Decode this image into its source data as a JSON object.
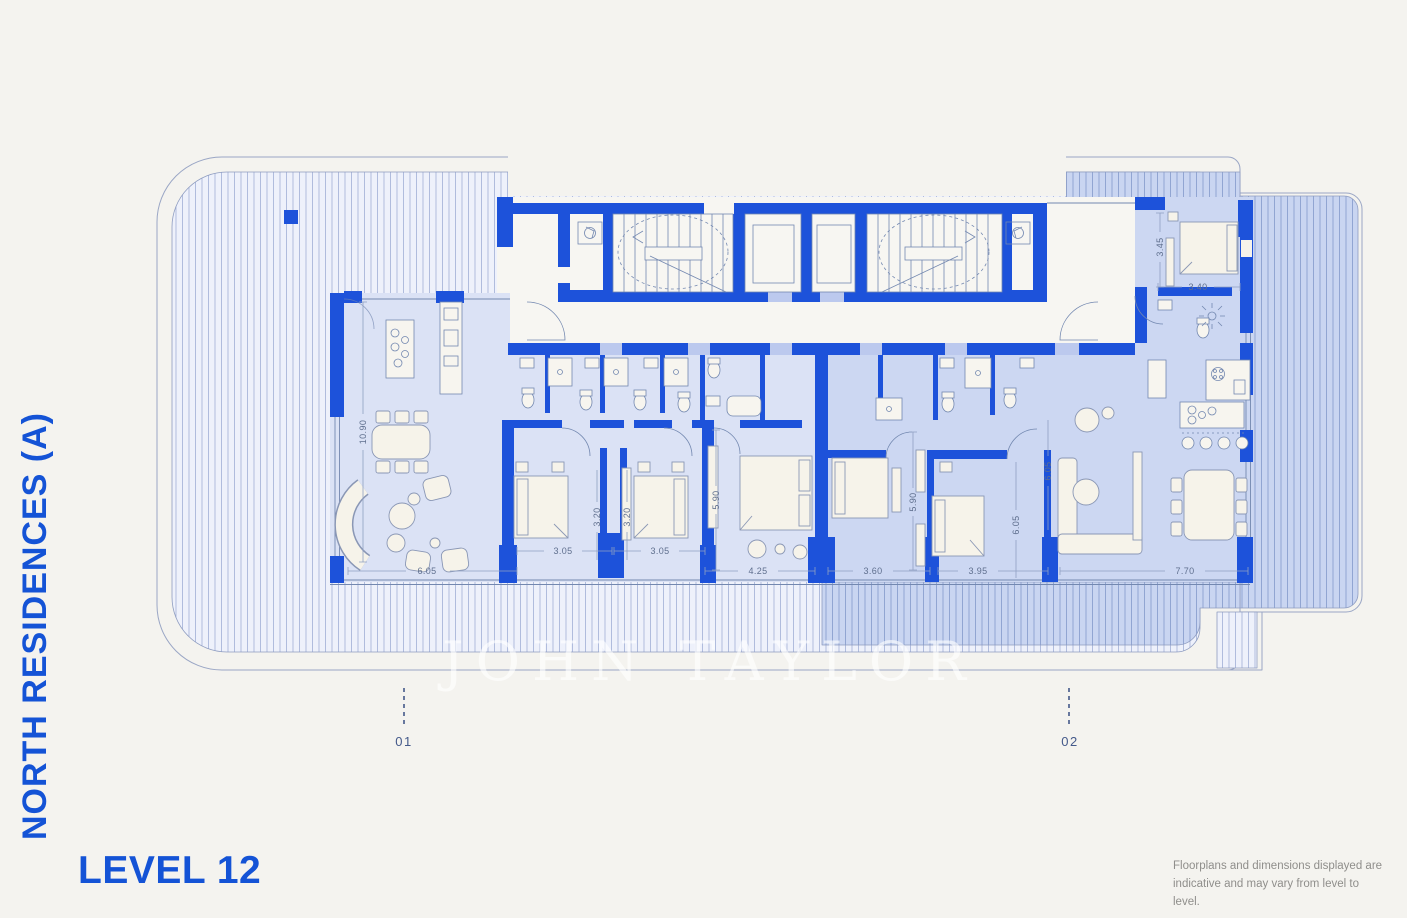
{
  "branding": {
    "project_title": "NORTH RESIDENCES (A)",
    "level_label": "LEVEL 12",
    "watermark": "JOHN TAYLOR"
  },
  "footer": {
    "disclaimer_line1": "Floorplans and dimensions displayed are",
    "disclaimer_line2": "indicative and may vary from level to level."
  },
  "unit_markers": [
    {
      "id": "01"
    },
    {
      "id": "02"
    }
  ],
  "dimensions": {
    "horizontal": [
      {
        "value": "6.05"
      },
      {
        "value": "3.05"
      },
      {
        "value": "3.05"
      },
      {
        "value": "4.25"
      },
      {
        "value": "3.60"
      },
      {
        "value": "3.95"
      },
      {
        "value": "7.70"
      },
      {
        "value": "3.40"
      }
    ],
    "vertical": [
      {
        "value": "10.90"
      },
      {
        "value": "3.20"
      },
      {
        "value": "3.20"
      },
      {
        "value": "5.90"
      },
      {
        "value": "5.90"
      },
      {
        "value": "6.05"
      },
      {
        "value": "6.05"
      },
      {
        "value": "3.45"
      }
    ]
  },
  "colors": {
    "background": "#f4f3ef",
    "accent_blue": "#1453d6",
    "wall_blue": "#1d52da",
    "room_light": "#dbe2f5",
    "room_dark": "#ccd7f2",
    "terrace_light": "#eef1fb",
    "terrace_dark": "#c9d5f1",
    "outline": "#9aa6c5",
    "dim_text": "#5f6f8e",
    "disclaimer_text": "#8f8e8b",
    "watermark_white": "rgba(255,255,255,0.62)"
  }
}
